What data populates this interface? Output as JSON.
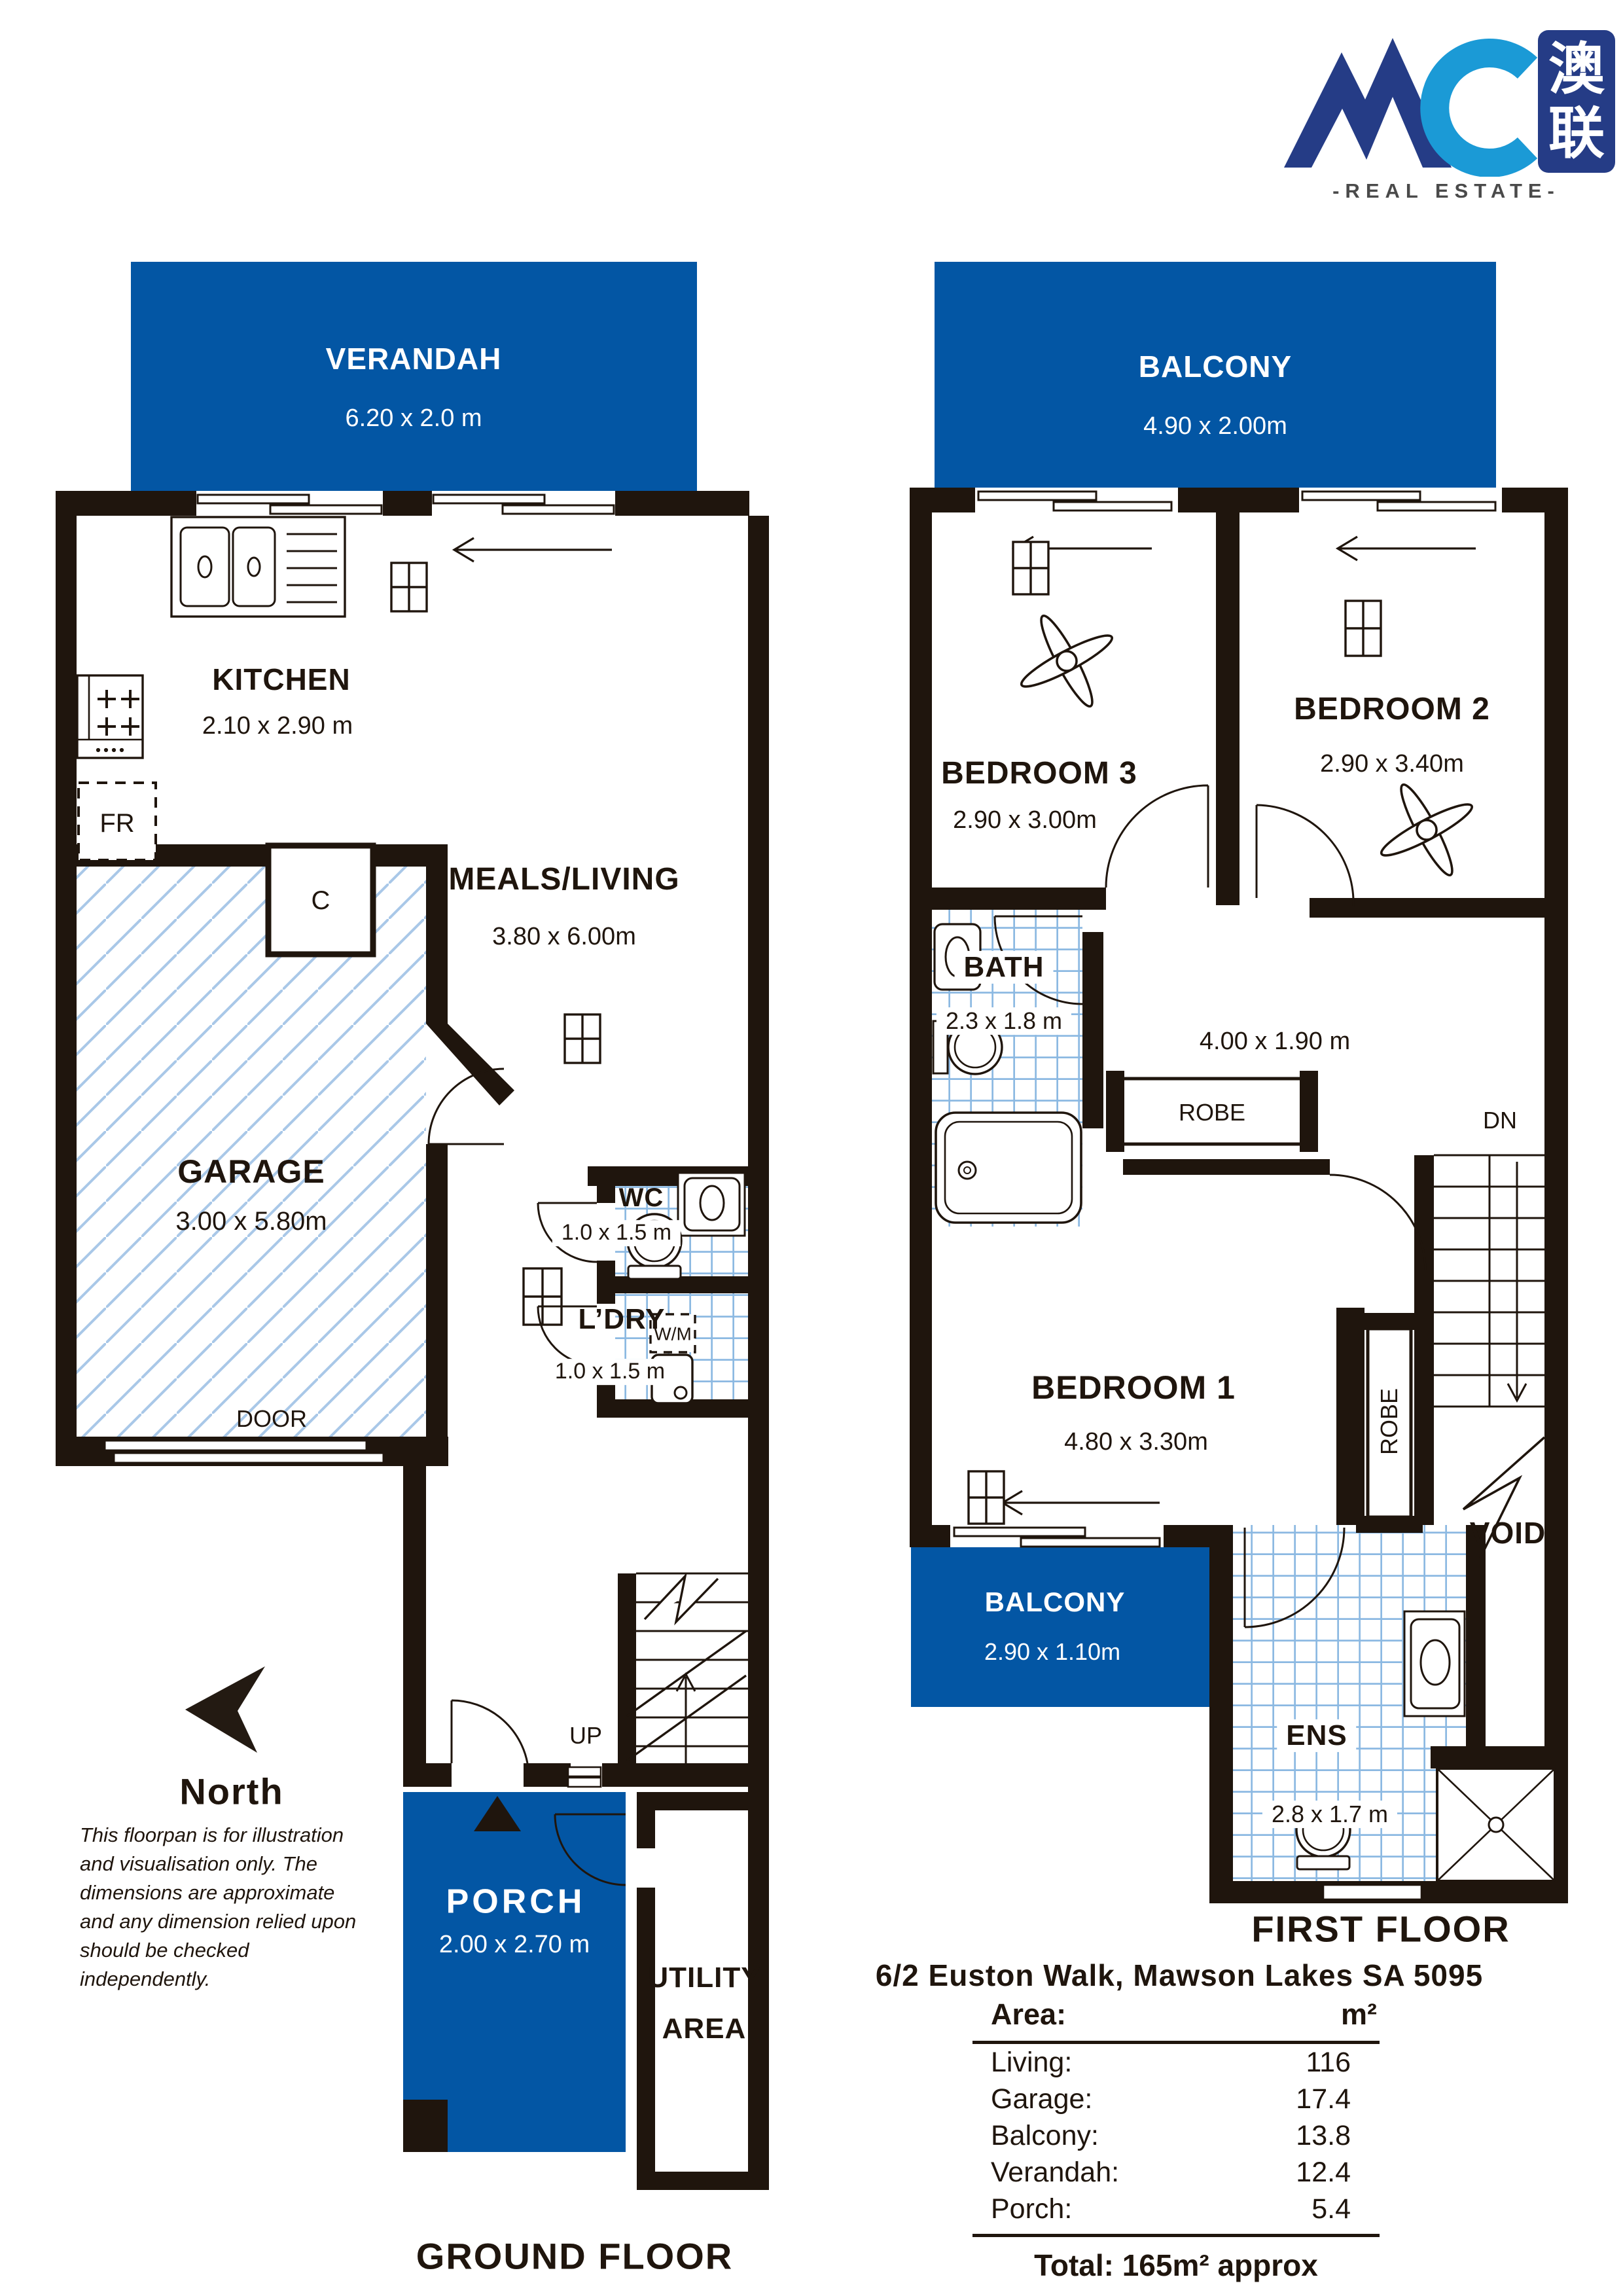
{
  "logo": {
    "brand": "AC",
    "cjk_top": "澳",
    "cjk_bottom": "联",
    "tagline": "-REAL ESTATE-"
  },
  "colors": {
    "plan_blue": "#0356a4",
    "wall_black": "#1f150d",
    "hatch_blue": "#a9c8e8",
    "tile_blue": "#8cb9e2",
    "logo_navy": "#253c86",
    "logo_light_blue": "#1b9ad6"
  },
  "ground_floor": {
    "title": "GROUND FLOOR",
    "verandah": {
      "label": "VERANDAH",
      "dims": "6.20 x 2.0 m"
    },
    "kitchen": {
      "label": "KITCHEN",
      "dims": "2.10 x 2.90 m"
    },
    "meals_living": {
      "label": "MEALS/LIVING",
      "dims": "3.80 x 6.00m"
    },
    "garage": {
      "label": "GARAGE",
      "dims": "3.00 x 5.80m",
      "door": "DOOR"
    },
    "wc": {
      "label": "WC",
      "dims": "1.0 x 1.5 m"
    },
    "laundry": {
      "label": "L’DRY",
      "dims": "1.0 x 1.5 m",
      "wm": "W/M"
    },
    "porch": {
      "label": "PORCH",
      "dims": "2.00 x 2.70 m"
    },
    "utility_line1": "UTILITY",
    "utility_line2": "AREA",
    "up": "UP",
    "fridge": "FR",
    "cupboard": "C"
  },
  "first_floor": {
    "title": "FIRST FLOOR",
    "balcony_top": {
      "label": "BALCONY",
      "dims": "4.90 x 2.00m"
    },
    "bedroom2": {
      "label": "BEDROOM 2",
      "dims": "2.90 x 3.40m"
    },
    "bedroom3": {
      "label": "BEDROOM 3",
      "dims": "2.90 x 3.00m"
    },
    "bath": {
      "label": "BATH",
      "dims": "2.3 x 1.8 m"
    },
    "hall_dims": "4.00 x 1.90 m",
    "robe_hall": "ROBE",
    "robe_bed1": "ROBE",
    "dn": "DN",
    "bedroom1": {
      "label": "BEDROOM 1",
      "dims": "4.80 x 3.30m"
    },
    "balcony_small": {
      "label": "BALCONY",
      "dims": "2.90 x 1.10m"
    },
    "ensuite": {
      "label": "ENS",
      "dims": "2.8 x 1.7 m"
    },
    "void": "VOID"
  },
  "north": {
    "label": "North"
  },
  "disclaimer": {
    "line1": "This floorpan is for illustration",
    "line2": "and visualisation only. The",
    "line3": "dimensions are approximate",
    "line4": "and any dimension relied upon",
    "line5": "should be checked",
    "line6": "independently."
  },
  "summary": {
    "address": "6/2 Euston Walk, Mawson Lakes SA 5095",
    "table": {
      "header_label": "Area:",
      "header_unit": "m²",
      "rows": [
        {
          "label": "Living:",
          "value": "116"
        },
        {
          "label": "Garage:",
          "value": "17.4"
        },
        {
          "label": "Balcony:",
          "value": "13.8"
        },
        {
          "label": "Verandah:",
          "value": "12.4"
        },
        {
          "label": "Porch:",
          "value": "5.4"
        }
      ],
      "total": "Total: 165m² approx"
    }
  }
}
